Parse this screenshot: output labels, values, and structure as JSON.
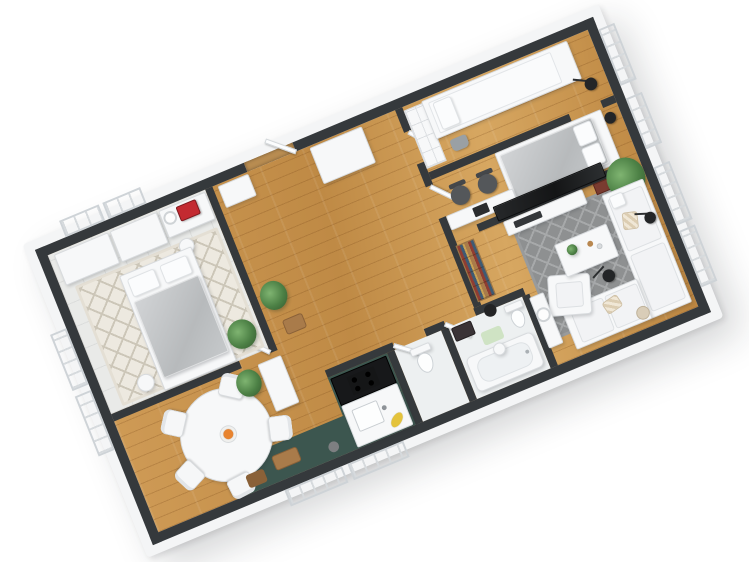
{
  "scene": {
    "title": "3D apartment floor plan render",
    "style": "isometric 3D top-down cutaway render on white background",
    "background": "#ffffff"
  },
  "palette": {
    "wallTop": "#35393c",
    "wallFace": "#f4f5f6",
    "wood": "#d09c57",
    "tealAccent": "#3c564f",
    "counterBlack": "#17181a",
    "rugCream": "#ede9e0",
    "rugCreamLine": "#ccc6b8",
    "rugGray": "#8e9091",
    "rugGrayLine": "#a7a9aa",
    "duvetGray": "#c0c3c5",
    "tvBlack": "#1d1f21",
    "plantGreen": "#4c8045",
    "plantDark": "#53575a",
    "orange": "#e8832e",
    "banana": "#e4c33c",
    "sewingRed": "#c32a31",
    "lampBlack": "#232527",
    "woodItem": "#a97b4a",
    "matGreen": "#cfe3c4",
    "bagGray": "#9aa0a4",
    "basketBeige": "#d9cdb8",
    "frameRust": "#7a3b30",
    "vaseBlack": "#232425"
  },
  "rooms": [
    {
      "name": "bedroom",
      "position": "left",
      "items": [
        "double bed with gray duvet",
        "cream diamond rug",
        "two wardrobes",
        "vanity desk with red sewing machine",
        "round mirror",
        "stool",
        "bedside table",
        "potted plant",
        "windows"
      ]
    },
    {
      "name": "dining-area",
      "position": "bottom-left",
      "items": [
        "round white table",
        "five shell chairs",
        "fruit bowl with oranges",
        "white sideboard",
        "potted plant",
        "windows"
      ]
    },
    {
      "name": "kitchen",
      "position": "bottom-center-left",
      "items": [
        "dark teal floor",
        "black cooktop counter",
        "white sink counter",
        "bananas",
        "wooden cutting board",
        "wooden crate",
        "gray ball"
      ]
    },
    {
      "name": "wc",
      "position": "bottom-center",
      "items": [
        "toilet",
        "door"
      ]
    },
    {
      "name": "bathroom",
      "position": "bottom-center-right",
      "items": [
        "bathtub",
        "toilet",
        "dark cabinet",
        "green bath mat",
        "round stool",
        "door"
      ]
    },
    {
      "name": "hallway",
      "position": "center",
      "items": [
        "entry door",
        "tall wardrobe",
        "shoe cabinet",
        "potted plant",
        "log basket",
        "wood floor"
      ]
    },
    {
      "name": "kids-bedroom",
      "position": "top-right",
      "items": [
        "daybed",
        "cube shelving unit",
        "gray bag",
        "floor lamp",
        "window"
      ]
    },
    {
      "name": "master-bedroom",
      "position": "center-right",
      "items": [
        "double bed with gray duvet",
        "long desk",
        "two office chairs",
        "laptop",
        "floor lamp",
        "window"
      ]
    },
    {
      "name": "living-room",
      "position": "right",
      "items": [
        "gray diamond rug",
        "corner sofa",
        "armchair",
        "coffee table",
        "wall TV",
        "media bench",
        "bookshelf",
        "tall plant",
        "floor lamps",
        "mirror console",
        "basket",
        "windows"
      ]
    }
  ]
}
